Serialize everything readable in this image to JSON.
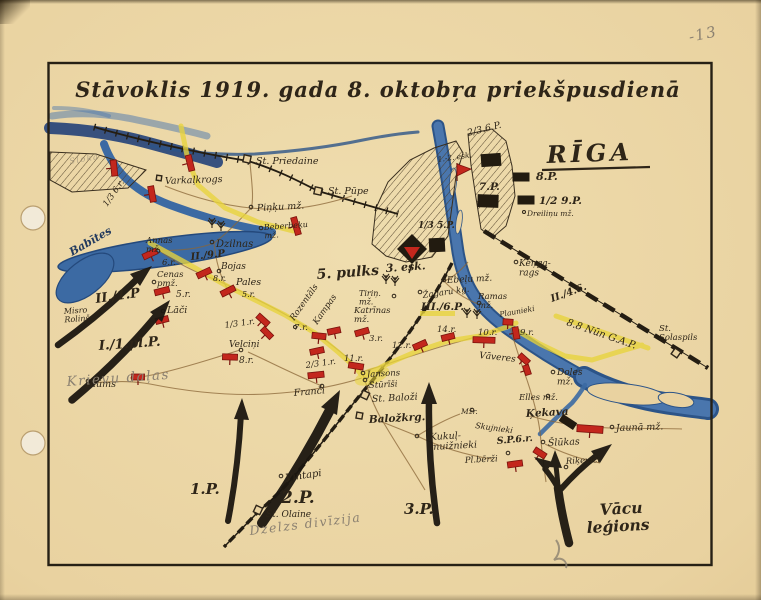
{
  "title": "Stāvoklis 1919. gada 8. oktobŗa priekšpusdienā",
  "colors": {
    "paper": "#e9d2a0",
    "ink": "#2e2518",
    "water": "#4a76ad",
    "water_dark": "#2c5488",
    "sea": "#1e3e77",
    "red": "#c3271d",
    "yellow": "#e8d43c",
    "pencil": "#8b8171",
    "road": "#8a6637"
  },
  "labels": {
    "page_no": "-13",
    "riga": "RĪGA",
    "p_2_3_6": "2/3.6.P.",
    "esk12": "1.-2. esk.",
    "p7": "7.P.",
    "p8": "8.P.",
    "p9h": "1/2 9.P.",
    "dreilinu": "Dreiliņu mž.",
    "p5t": "1/3 5.P.",
    "esk3": "3. esk.",
    "st_priedaine": "St. Priedaine",
    "st_pupe": "St. Pūpe",
    "pinku": "Piņķu mž.",
    "beberbeku": "Beberbeķu\nmž.",
    "dzilnas": "Dzilnas",
    "varkalkrogs": "Varkaļkrogs",
    "sloka": "Sloka",
    "r6_13": "1/3 6.r.",
    "babites": "Babītes",
    "annas": "Annas\nmž.",
    "r6": "6.r.",
    "p9_II": "II./9.P",
    "bojas": "Bojas",
    "r8b": "8.r.",
    "cenas": "Cenas\npmž.",
    "pales": "Pales",
    "r5b": "5.r.",
    "r5": "5.r.",
    "laci": "Lāči",
    "misro": "Misro\nRoliņš",
    "p1_II": "II./1.P",
    "p1_I": "I./1.pl.P.",
    "krievu": "Krievu daļas",
    "r1_13": "1/3 1.r.",
    "velcini": "Velciņi",
    "r8": "8.r.",
    "blums": "Blūms",
    "franci": "Franči",
    "r1_23": "2/3 1.r.",
    "pulks5": "5. pulks",
    "tirin": "Tiriņ.\nmž.",
    "rozentals": "Rozentāls",
    "kampas": "Kampas",
    "r7": "7.r.",
    "katrinas": "Katrīnas\nmž.",
    "r3": "3.r.",
    "r11": "11.r.",
    "r12": "12.r.",
    "ebelu": "Ebeļu mž.",
    "zagaru": "Žagaru kg.",
    "p6_III": "III./6.P.",
    "ramas": "Ramas\nmž.",
    "r14": "14.r.",
    "r10": "10.r.",
    "r9": "9.r.",
    "plaunieki": "Plaunieki",
    "vaveres": "Vāveres",
    "kenga": "Keņga-\nrags",
    "p46_II": "II./4.6.",
    "nun": "8.8 Nūn G.A.P.",
    "st_salaspils": "St.\nSolaspils",
    "doles": "Doles\nmž.",
    "elles": "Elles mž.",
    "kekava": "Ķekava",
    "jauna": "Jaunā mž.",
    "slukas": "Šlūkas",
    "rikevici": "Riķeviči",
    "sp6r": "S.P.6.r.",
    "plberzi": "Pl.bērži",
    "mzr": "Mžr.",
    "skujnieki": "Skujnieki",
    "kukul": "Kukuļ-\nmuižnieki",
    "balozkrg": "Baložkrg.",
    "st_balozi": "St. Baloži",
    "sturisi": "Stūrīši",
    "jansons": "Jansons",
    "p1": "1.P.",
    "p2": "2.P.",
    "p3": "3.P.",
    "vintapi": "Vintapi",
    "st_olaine": "St. Olaine",
    "dzelzs": "Dzelzs divīzija",
    "vacu_1": "Vācu",
    "vacu_2": "leģions"
  }
}
